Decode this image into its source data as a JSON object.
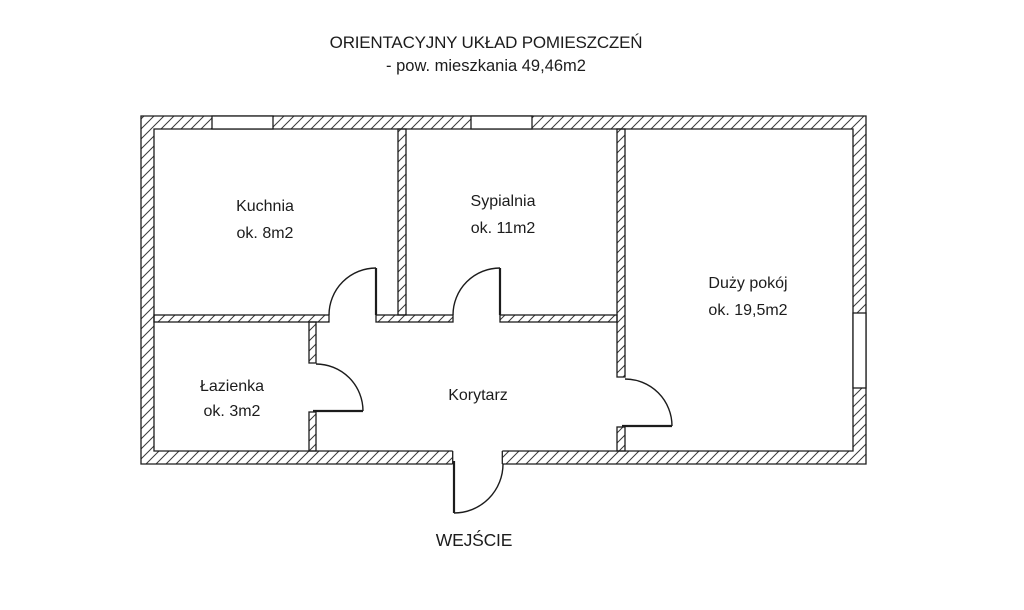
{
  "header": {
    "title": "ORIENTACYJNY UKŁAD POMIESZCZEŃ",
    "subtitle": "- pow. mieszkania 49,46m2"
  },
  "rooms": {
    "kuchnia": {
      "name": "Kuchnia",
      "area": "ok. 8m2"
    },
    "sypialnia": {
      "name": "Sypialnia",
      "area": "ok. 11m2"
    },
    "duzy_pokoj": {
      "name": "Duży pokój",
      "area": "ok. 19,5m2"
    },
    "lazienka": {
      "name": "Łazienka",
      "area": "ok. 3m2"
    },
    "korytarz": {
      "name": "Korytarz"
    }
  },
  "entrance": {
    "label": "WEJŚCIE"
  },
  "colors": {
    "line": "#1c1c1c",
    "hatch": "#3a3a3a",
    "background": "#ffffff"
  }
}
